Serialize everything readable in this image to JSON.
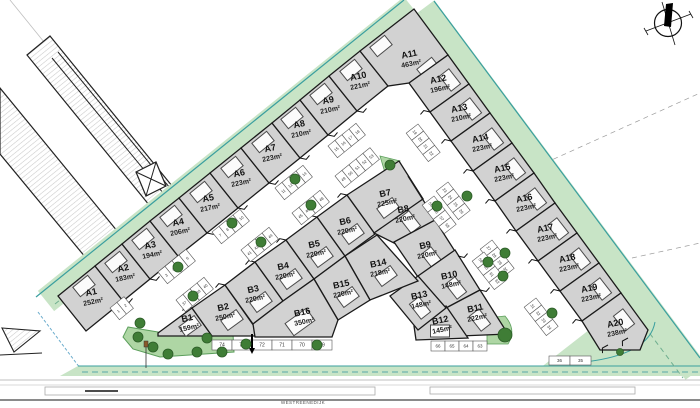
{
  "lots": [
    {
      "id": "A1",
      "area": "252m²"
    },
    {
      "id": "A2",
      "area": "183m²"
    },
    {
      "id": "A3",
      "area": "194m²"
    },
    {
      "id": "A4",
      "area": "206m²"
    },
    {
      "id": "A5",
      "area": "217m²"
    },
    {
      "id": "A6",
      "area": "223m²"
    },
    {
      "id": "A7",
      "area": "223m²"
    },
    {
      "id": "A8",
      "area": "210m²"
    },
    {
      "id": "A9",
      "area": "210m²"
    },
    {
      "id": "A10",
      "area": "221m²"
    },
    {
      "id": "A11",
      "area": "463m²"
    },
    {
      "id": "A12",
      "area": "196m²"
    },
    {
      "id": "A13",
      "area": "210m²"
    },
    {
      "id": "A14",
      "area": "223m²"
    },
    {
      "id": "A15",
      "area": "223m²"
    },
    {
      "id": "A16",
      "area": "223m²"
    },
    {
      "id": "A17",
      "area": "223m²"
    },
    {
      "id": "A18",
      "area": "223m²"
    },
    {
      "id": "A19",
      "area": "223m²"
    },
    {
      "id": "A20",
      "area": "238m²"
    },
    {
      "id": "B1",
      "area": "159m²"
    },
    {
      "id": "B2",
      "area": "250m²"
    },
    {
      "id": "B3",
      "area": "220m²"
    },
    {
      "id": "B4",
      "area": "220m²"
    },
    {
      "id": "B5",
      "area": "220m²"
    },
    {
      "id": "B6",
      "area": "220m²"
    },
    {
      "id": "B7",
      "area": "225m²"
    },
    {
      "id": "B8",
      "area": "220m²"
    },
    {
      "id": "B9",
      "area": "220m²"
    },
    {
      "id": "B10",
      "area": "148m²"
    },
    {
      "id": "B11",
      "area": "222m²"
    },
    {
      "id": "B12",
      "area": "145m²"
    },
    {
      "id": "B13",
      "area": "148m²"
    },
    {
      "id": "B14",
      "area": "218m²"
    },
    {
      "id": "B15",
      "area": "220m²"
    },
    {
      "id": "B16",
      "area": "350m²"
    }
  ],
  "parking": {
    "clusters": [
      {
        "stalls": [
          "1",
          "2"
        ]
      },
      {
        "stalls": [
          "3",
          "4",
          "5",
          "6"
        ]
      },
      {
        "stalls": [
          "7",
          "8",
          "9",
          "10"
        ]
      },
      {
        "stalls": [
          "11",
          "12",
          "13",
          "14"
        ]
      },
      {
        "stalls": [
          "15",
          "16",
          "17",
          "18"
        ]
      },
      {
        "stalls": [
          "19",
          "20",
          "21",
          "22"
        ]
      },
      {
        "stalls": [
          "23",
          "24",
          "25",
          "26"
        ]
      },
      {
        "stalls": [
          "27",
          "28",
          "29",
          "30"
        ]
      },
      {
        "stalls": [
          "31",
          "32",
          "33",
          "34"
        ]
      },
      {
        "stalls": [
          "36",
          "35"
        ]
      },
      {
        "stalls": [
          "37",
          "38",
          "39",
          "40"
        ]
      },
      {
        "stalls": [
          "41",
          "42",
          "43",
          "44"
        ]
      },
      {
        "stalls": [
          "45",
          "46",
          "47",
          "48"
        ]
      },
      {
        "stalls": [
          "49",
          "50",
          "51",
          "52",
          "53"
        ]
      },
      {
        "stalls": [
          "55",
          "56",
          "57",
          "58"
        ]
      },
      {
        "stalls": [
          "59",
          "60",
          "61",
          "62"
        ]
      },
      {
        "stalls": [
          "74",
          "73",
          "72",
          "71",
          "70",
          "69"
        ]
      },
      {
        "stalls": [
          "66",
          "65",
          "64",
          "63"
        ]
      }
    ]
  },
  "street": {
    "name": "WESTREENEDIJK"
  },
  "icons": {
    "compass": "north-arrow"
  },
  "colors": {
    "lot_fill": "#d2d2d2",
    "lot_stroke": "#1a1a1a",
    "green_buffer": "#c8e4c6",
    "teal_edge": "#3a9f9f",
    "park_green": "#aed6a4",
    "tree_green": "#3f7d36",
    "hatch_gray": "#c9c9c9"
  }
}
